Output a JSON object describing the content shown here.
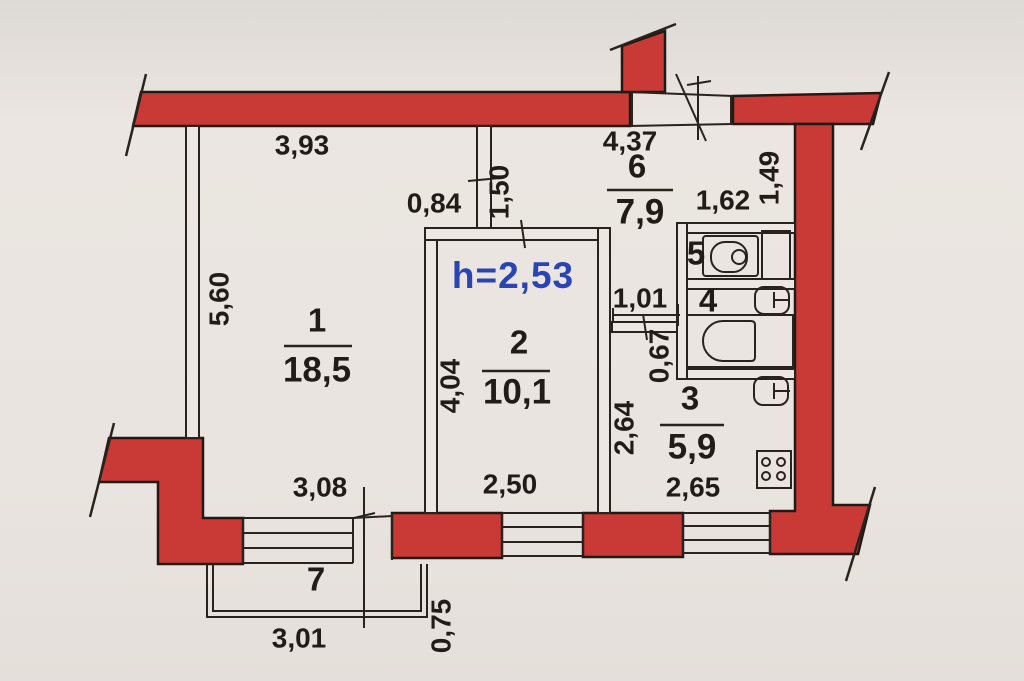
{
  "plan": {
    "ceiling_height": "h=2,53",
    "rooms": [
      {
        "number": "1",
        "area": "18,5"
      },
      {
        "number": "2",
        "area": "10,1"
      },
      {
        "number": "3",
        "area": "5,9"
      },
      {
        "number": "4",
        "area": ""
      },
      {
        "number": "5",
        "area": ""
      },
      {
        "number": "6",
        "area": "7,9"
      },
      {
        "number": "7",
        "area": ""
      }
    ],
    "dims": {
      "room1_top": "3,93",
      "room1_left": "5,60",
      "room1_bottom": "3,08",
      "opening_top": "0,84",
      "partition": "1,50",
      "hall_top": "4,37",
      "entry_side": "1,49",
      "toilet_top": "1,62",
      "corridor": "1,01",
      "bath_side": "0,67",
      "kitchen_left": "2,64",
      "room2_left": "4,04",
      "room2_bottom": "2,50",
      "kitchen_bottom": "2,65",
      "balcony_side": "0,75",
      "balcony_bottom": "3,01"
    }
  },
  "colors": {
    "wall": "#c93a37",
    "paper": "#e9e5e0",
    "ink": "#29231d",
    "accent_blue": "#2b44b4"
  }
}
